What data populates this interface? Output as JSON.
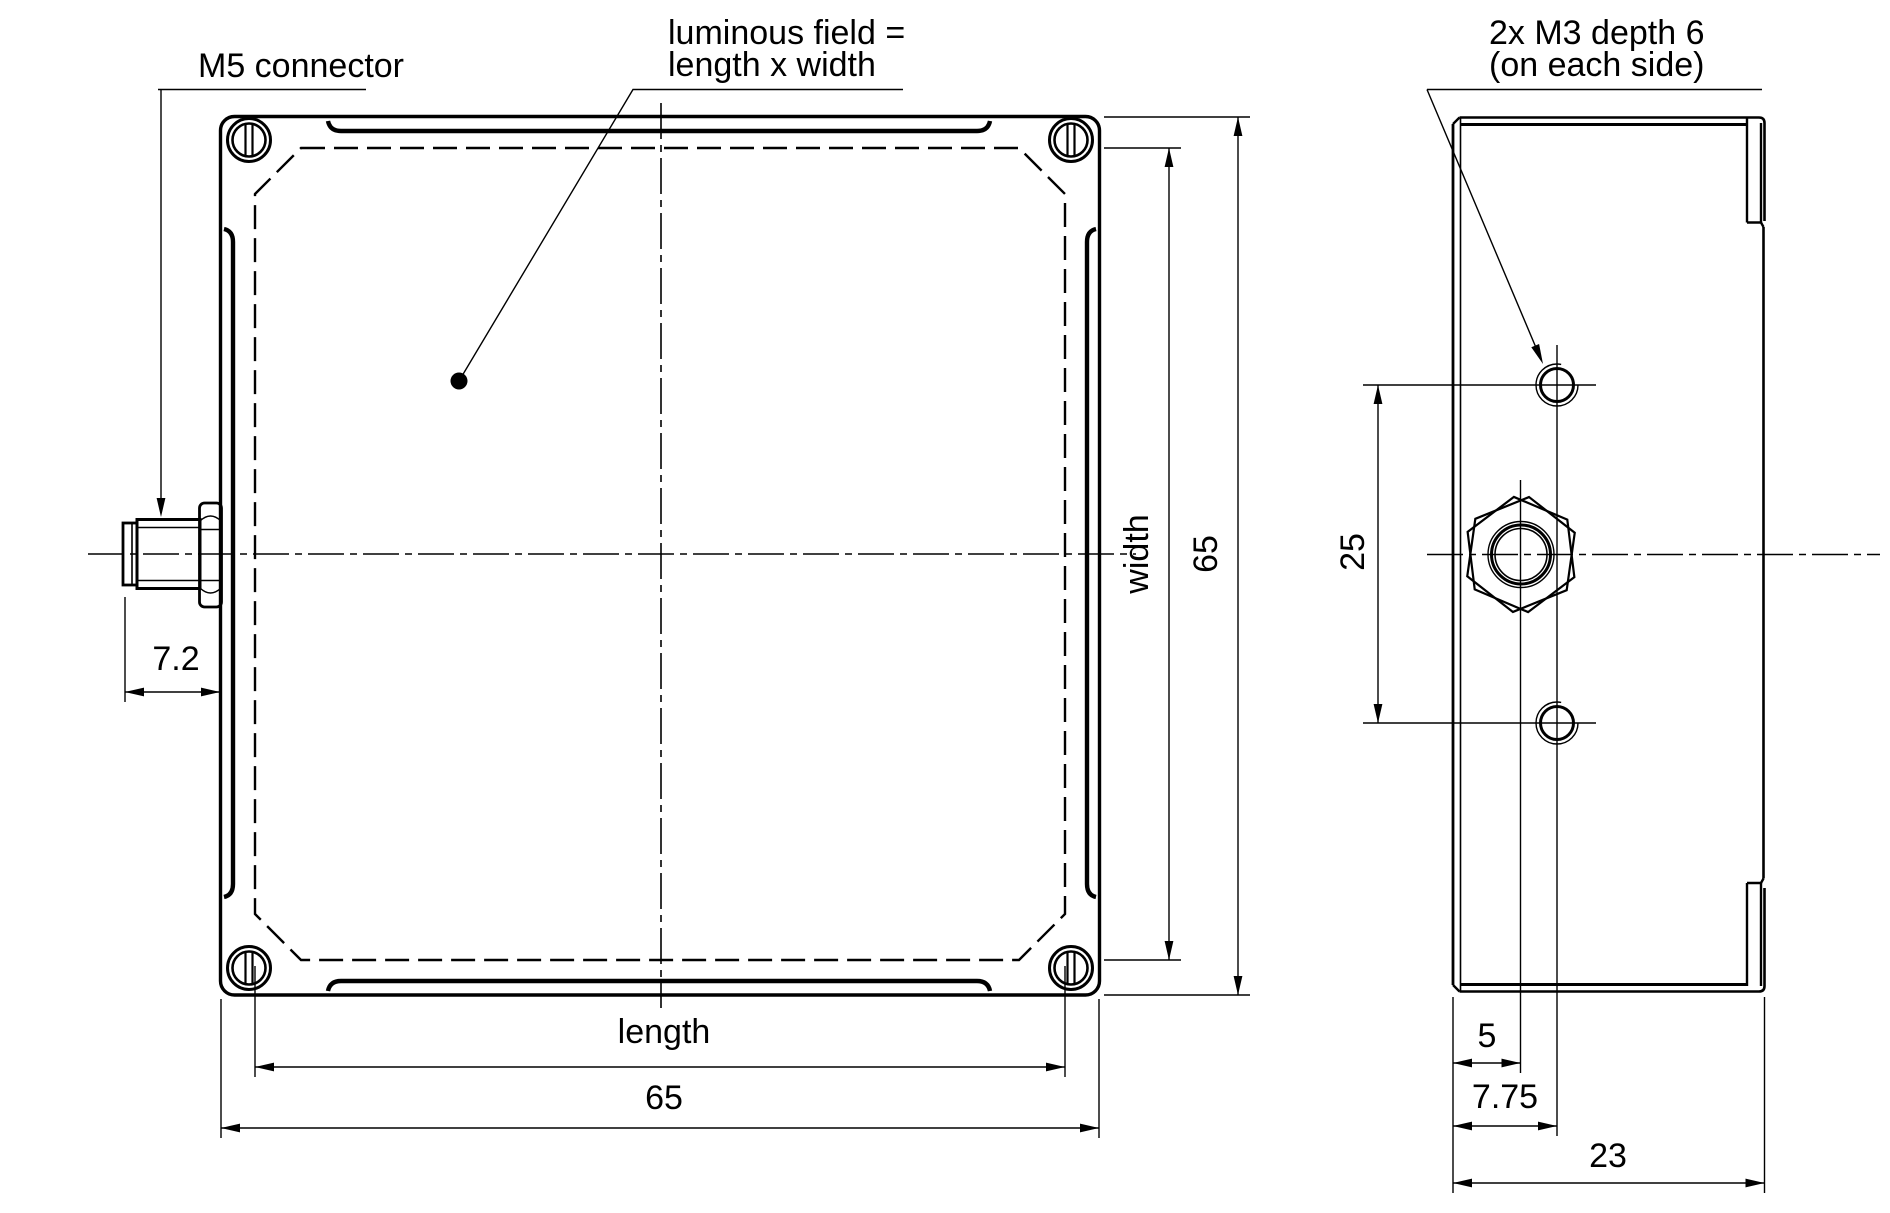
{
  "drawing_type": "technical dimension drawing, front and side view of luminous panel",
  "units": "mm",
  "colors": {
    "line": "#000000",
    "luminous_field": "#b9b9b9",
    "background": "#ffffff"
  },
  "front_view": {
    "callouts": {
      "m5_connector": "M5 connector",
      "luminous_field_line1": "luminous field =",
      "luminous_field_line2": "length x width"
    },
    "dimensions": {
      "connector_protrusion": "7.2",
      "length_label": "length",
      "length_value": "65",
      "width_label": "width",
      "width_value": "65"
    }
  },
  "side_view": {
    "callouts": {
      "m3_line1": "2x M3 depth 6",
      "m3_line2": "(on each side)"
    },
    "dimensions": {
      "hole_spacing": "25",
      "connector_offset": "5",
      "hole_offset": "7.75",
      "depth": "23"
    }
  }
}
